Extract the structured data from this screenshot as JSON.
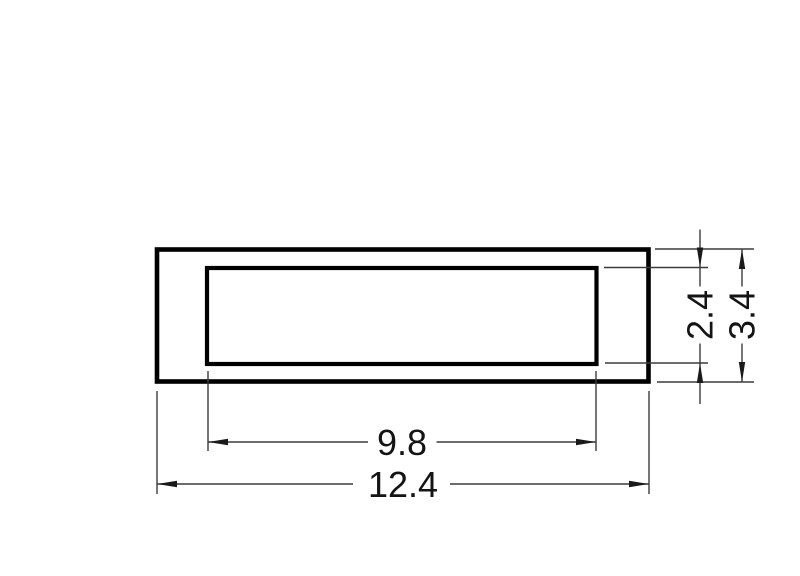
{
  "drawing": {
    "background": "#ffffff",
    "outline_color": "#000000",
    "dim_line_color": "#3c3c3c",
    "arrow_color": "#1a1a1a",
    "text_color": "#141414",
    "dimensions": {
      "outer_width": {
        "label": "12.4",
        "value": 12.4,
        "orientation": "horizontal"
      },
      "inner_width": {
        "label": "9.8",
        "value": 9.8,
        "orientation": "horizontal"
      },
      "outer_height": {
        "label": "3.4",
        "value": 3.4,
        "orientation": "vertical"
      },
      "inner_height": {
        "label": "2.4",
        "value": 2.4,
        "orientation": "vertical"
      }
    }
  }
}
